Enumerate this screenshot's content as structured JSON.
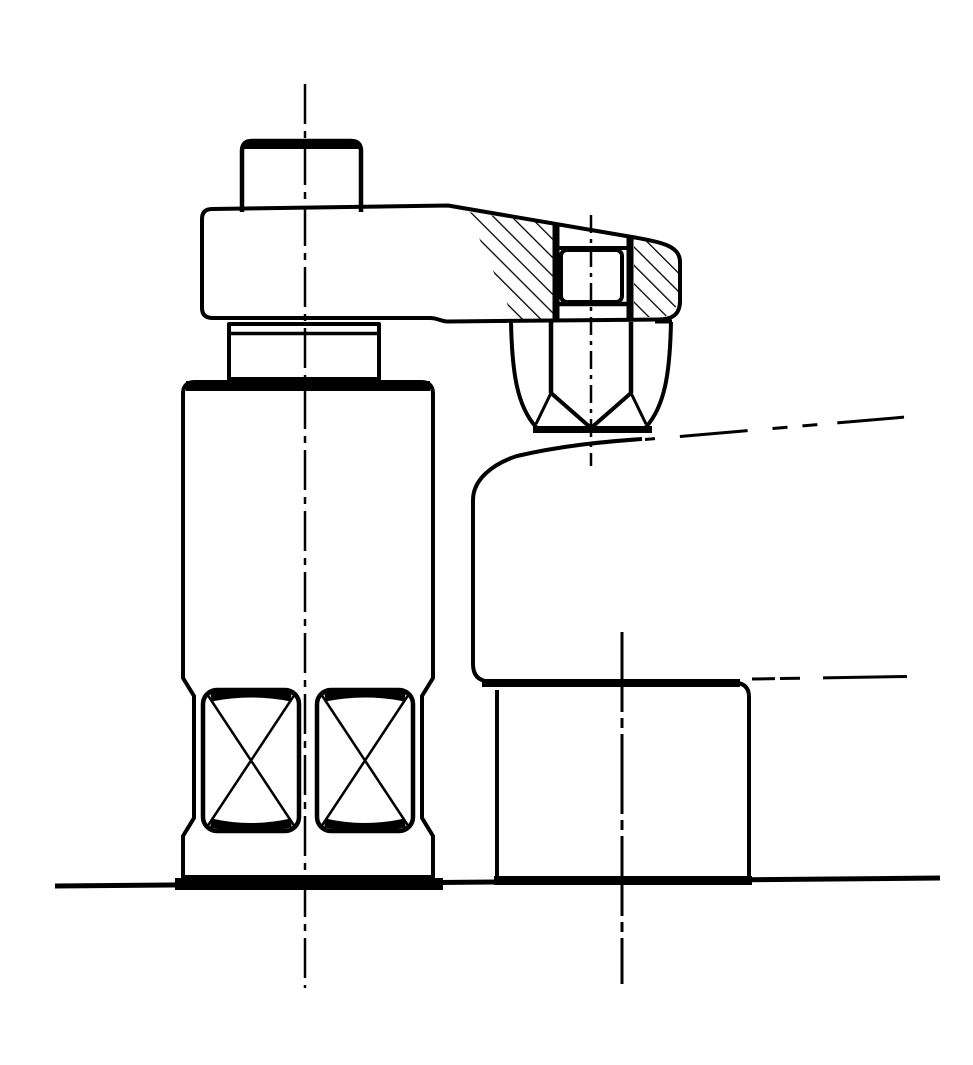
{
  "figure": {
    "background": "#ffffff",
    "ink": "#000000",
    "description": "Sectional technical line drawing of a machine clamping setup: a clamp strap with a bolt head at the left, supported by a spring-loaded cylinder containing two X-marked spring elements, and at the right end a sectioned (hatched) strap boss with a slot nut and a hex pressure nut clamping a workpiece that rests on a riser block on the table surface. Chain dash-dot center lines mark the bolt axis, screw axis, block axis and workpiece axis."
  },
  "parts": [
    "clamp-bolt-head",
    "clamp-arm",
    "section-hatching-left",
    "section-hatching-right",
    "screw-slot",
    "slot-nut",
    "pressure-nut",
    "support-collar-nut",
    "spring-support-cylinder",
    "spring-element-left",
    "spring-element-right",
    "workpiece",
    "riser-block",
    "table-surface-line",
    "center-line-bolt",
    "center-line-screw",
    "center-line-block",
    "workpiece-axis-chain-line",
    "bore-axis-chain-line"
  ]
}
